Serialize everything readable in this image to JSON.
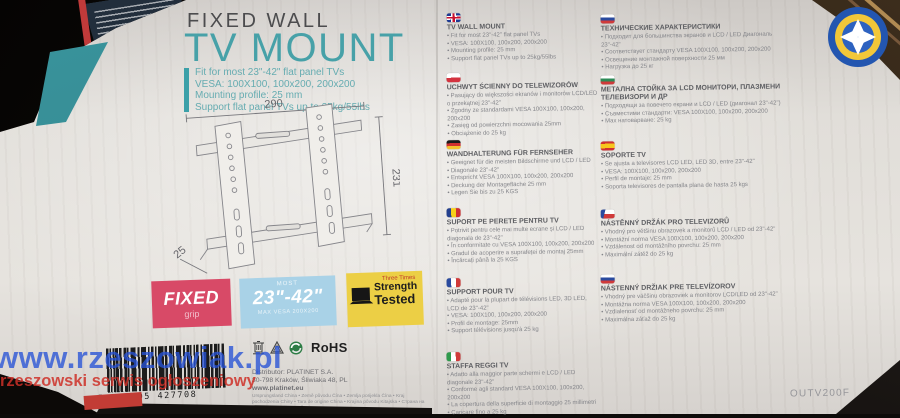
{
  "watermark": {
    "site": "www.rzeszowiak.pl",
    "tagline": "rzeszowski serwis ogłoszeniowy"
  },
  "header": {
    "line1": "FIXED WALL",
    "line2": "TV MOUNT",
    "specs": [
      "Fit for most 23\"-42\" flat panel TVs",
      "VESA: 100X100, 100x200, 200x200",
      "Mounting profile: 25 mm",
      "Support flat panel TVs up to 25kg/55lbs"
    ]
  },
  "diagram": {
    "width_label": "290",
    "height_label": "231",
    "depth_label": "25"
  },
  "badges": {
    "fixed": {
      "title": "FIXED",
      "subtitle": "grip"
    },
    "size": {
      "top": "MOST",
      "title": "23\"-42\"",
      "bottom": "MAX VESA 200X200"
    },
    "strength": {
      "top": "Three Times",
      "line1": "Strength",
      "line2": "Tested"
    }
  },
  "barcode": {
    "number": "5 907595 427708"
  },
  "compliance": {
    "rohs": "RoHS"
  },
  "distributor": {
    "line1": "Distributor: PLATINET S.A.",
    "line2": "30-798 Kraków, Śliwiaka 48, PL",
    "line3": "www.platinet.eu",
    "origin": "Ursprungsland China • Země původu Čína • Zemlja porijekla Čína • Kraj pochodzenia Chiny • Tara de origine China • Krajina pôvodu Kitajska • Страна на произход Китай • صنع في الصين"
  },
  "model": "OUTV200F",
  "languages_left": [
    {
      "lang": "en",
      "title": "TV WALL MOUNT",
      "lines": [
        "• Fit for most 23\"-42\" flat panel TVs",
        "• VESA: 100X100, 100x200, 200x200",
        "• Mounting profile: 25 mm",
        "• Support flat panel TVs up to 25kg/55lbs"
      ]
    },
    {
      "lang": "pl",
      "title": "UCHWYT ŚCIENNY DO TELEWIZORÓW",
      "lines": [
        "• Pasujący do większości ekranów i monitorów LCD/LED o przekątnej 23\"-42\"",
        "• Zgodny ze standardami VESA 100X100, 100x200, 200x200",
        "• Zasięg od powierzchni mocowania 25mm",
        "• Obciążenie do 25 kg"
      ]
    },
    {
      "lang": "de",
      "title": "WANDHALTERUNG FÜR FERNSEHER",
      "lines": [
        "• Geeignet für die meisten Bildschirme und LCD / LED",
        "• Diagonale 23\"-42\"",
        "• Entspricht VESA 100X100, 100x200, 200x200",
        "• Deckung der Montagefläche 25 mm",
        "• Legen Sie bis zu 25 KGS"
      ]
    },
    {
      "lang": "ro",
      "title": "SUPORT PE PERETE PENTRU TV",
      "lines": [
        "• Potrivit pentru cele mai multe ecrane și LCD / LED diagonala de 23\"-42\"",
        "• În conformitate cu VESA 100X100, 100x200, 200x200",
        "• Gradul de acoperire a suprafeței de montaj 25mm",
        "• Încărcați până la 25 KGS"
      ]
    },
    {
      "lang": "fr",
      "title": "SUPPORT POUR TV",
      "lines": [
        "• Adapté pour la plupart de télévisions LED, 3D LED, LCD de 23\"-42\"",
        "• VESA: 100X100, 100x200, 200x200",
        "• Profil de montage: 25mm",
        "• Support télévisions jusqu'à 25 kg"
      ]
    },
    {
      "lang": "it",
      "title": "STAFFA REGGI TV",
      "lines": [
        "• Adatto alla maggior parte schermi e LCD / LED diagonale 23\"-42\"",
        "• Conforme agli standard VESA 100X100, 100x200, 200x200",
        "• La copertura della superficie di montaggio 25 millimetri",
        "• Caricare fino a 25 kg"
      ]
    }
  ],
  "languages_right": [
    {
      "lang": "ru",
      "title": "ТЕХНИЧЕСКИЕ ХАРАКТЕРИСТИКИ",
      "lines": [
        "• Подходит для большинства экранов и LCD / LED Диагональ 23\"-42\"",
        "• Соответствует стандарту VESA 100X100, 100x200, 200x200",
        "• Освещение монтажной поверхности 25 мм",
        "• Нагрузка до 25 кг"
      ]
    },
    {
      "lang": "bg",
      "title": "МЕТАЛНА СТОЙКА ЗА LCD МОНИТОРИ, ПЛАЗМЕНИ ТЕЛЕВИЗОРИ И ДР",
      "lines": [
        "• Подходящи за повечето екрани и LCD / LED (диагонал 23\"-42\")",
        "• Съвместими стандарти: VESA 100X100, 100x200, 200x200",
        "• Max натоварване: 25 kg"
      ]
    },
    {
      "lang": "es",
      "title": "SOPORTE TV",
      "lines": [
        "• Se ajusta a televisores LCD LED, LED 3D, entre 23\"-42\"",
        "• VESA: 100X100, 100x200, 200x200",
        "• Perfil de montaje: 25 mm",
        "• Soporta televisores de pantalla plana de hasta 25 kgs"
      ]
    },
    {
      "lang": "cz",
      "title": "NÁSTĚNNÝ DRŽÁK PRO TELEVIZORŮ",
      "lines": [
        "• Vhodný pro většinu obrazovek a monitorů LCD / LED od 23\"-42\"",
        "• Montážní norma VESA 100X100, 100x200, 200x200",
        "• Vzdálenost od montážního povrchu: 25 mm",
        "• Maximální zátěž do 25 kg"
      ]
    },
    {
      "lang": "sk",
      "title": "NÁSTENNÝ DRŽIAK PRE TELEVÍZOROV",
      "lines": [
        "• Vhodný pre väčšinu obrazoviek a monitorov LCD/LED od 23\"-42\"",
        "• Montážna norma VESA 100X100, 100x200, 200x200",
        "• Vzdialenosť od montážneho povrchu: 25 mm",
        "• Maximálna záťaž do 25 kg"
      ]
    }
  ]
}
